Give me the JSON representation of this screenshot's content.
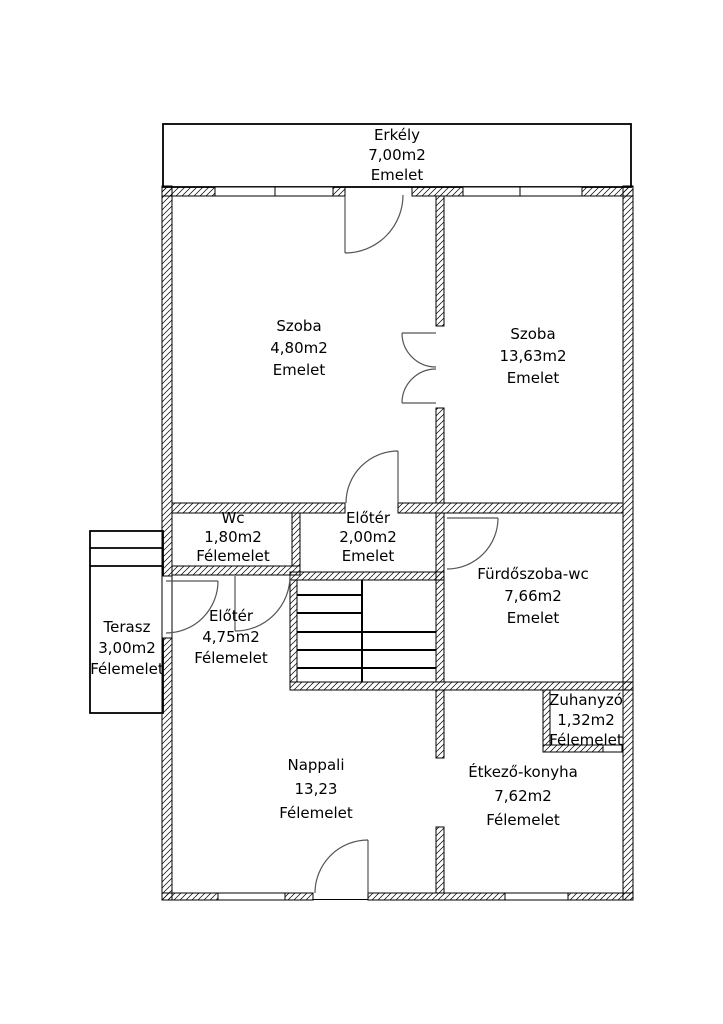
{
  "floorplan": {
    "rooms": [
      {
        "id": "erkely",
        "name": "Erkély",
        "area": "7,00m2",
        "level": "Emelet"
      },
      {
        "id": "szoba-left",
        "name": "Szoba",
        "area": "4,80m2",
        "level": "Emelet"
      },
      {
        "id": "szoba-right",
        "name": "Szoba",
        "area": "13,63m2",
        "level": "Emelet"
      },
      {
        "id": "wc",
        "name": "Wc",
        "area": "1,80m2",
        "level": "Félemelet"
      },
      {
        "id": "eloter-upper",
        "name": "Előtér",
        "area": "2,00m2",
        "level": "Emelet"
      },
      {
        "id": "furdoszoba-wc",
        "name": "Fürdőszoba-wc",
        "area": "7,66m2",
        "level": "Emelet"
      },
      {
        "id": "eloter-lower",
        "name": "Előtér",
        "area": "4,75m2",
        "level": "Félemelet"
      },
      {
        "id": "terasz",
        "name": "Terasz",
        "area": "3,00m2",
        "level": "Félemelet"
      },
      {
        "id": "zuhanyzo",
        "name": "Zuhanyzó",
        "area": "1,32m2",
        "level": "Félemelet"
      },
      {
        "id": "nappali",
        "name": "Nappali",
        "area": "13,23",
        "level": "Félemelet"
      },
      {
        "id": "etkezo-konyha",
        "name": "Étkező-konyha",
        "area": "7,62m2",
        "level": "Félemelet"
      }
    ],
    "colors": {
      "wall_line": "#000000",
      "door_line": "#555555",
      "background": "#ffffff"
    }
  }
}
